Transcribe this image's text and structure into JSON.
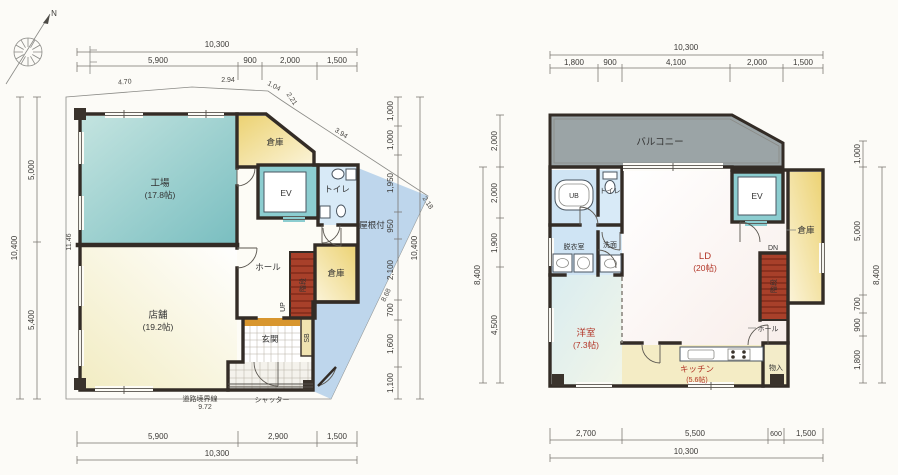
{
  "compass": {
    "label": "N"
  },
  "floor1": {
    "dim_top": {
      "total": "10,300",
      "segs": [
        "5,900",
        "900",
        "2,000",
        "1,500"
      ]
    },
    "dim_bottom": {
      "total": "10,300",
      "segs": [
        "5,900",
        "2,900",
        "1,500"
      ]
    },
    "dim_left": {
      "total": "10,400",
      "segs": [
        "5,000",
        "5,400"
      ],
      "wall": "11.46"
    },
    "dim_right": {
      "total": "10,400",
      "segs": [
        "1,000",
        "1,000",
        "1,950",
        "950",
        "2,100",
        "700",
        "1,600",
        "1,100"
      ]
    },
    "boundary": {
      "top": [
        "4.70",
        "2.94",
        "1.04",
        "2.21",
        "3.94"
      ],
      "tip": "2.18",
      "diagonal": "8.68",
      "bottom_label": "道路境界線",
      "bottom_value": "9.72"
    },
    "rooms": {
      "factory": {
        "name": "工場",
        "size": "(17.8帖)"
      },
      "shop": {
        "name": "店舗",
        "size": "(19.2帖)"
      },
      "storage_top": "倉庫",
      "storage_mid": "倉庫",
      "ev": "EV",
      "toilet": "トイレ",
      "hall": "ホール",
      "entrance": "玄関",
      "shoebox": "SB",
      "stairs": "階段",
      "up": "UP",
      "roofed": "屋根付",
      "shutter": "シャッター"
    }
  },
  "floor2": {
    "dim_top": {
      "total": "10,300",
      "segs": [
        "1,800",
        "900",
        "4,100",
        "2,000",
        "1,500"
      ]
    },
    "dim_bottom": {
      "total": "10,300",
      "segs": [
        "2,700",
        "5,500",
        "600",
        "1,500"
      ]
    },
    "dim_left": {
      "balcony": "2,000",
      "total": "8,400",
      "segs": [
        "2,000",
        "1,900",
        "4,500"
      ]
    },
    "dim_right": {
      "top": "1,000",
      "total": "8,400",
      "segs": [
        "5,000",
        "700",
        "900",
        "1,800"
      ]
    },
    "rooms": {
      "balcony": "バルコニー",
      "ld": {
        "name": "LD",
        "size": "(20帖)"
      },
      "western": {
        "name": "洋室",
        "size": "(7.3帖)"
      },
      "kitchen": {
        "name": "キッチン",
        "size": "(5.6帖)"
      },
      "ub": "UB",
      "toilet": "トイレ",
      "dressing": "脱衣室",
      "washroom": "洗面",
      "storage": "倉庫",
      "closet": "物入",
      "ev": "EV",
      "hall": "ホール",
      "stairs": "階段",
      "dn": "DN"
    }
  }
}
